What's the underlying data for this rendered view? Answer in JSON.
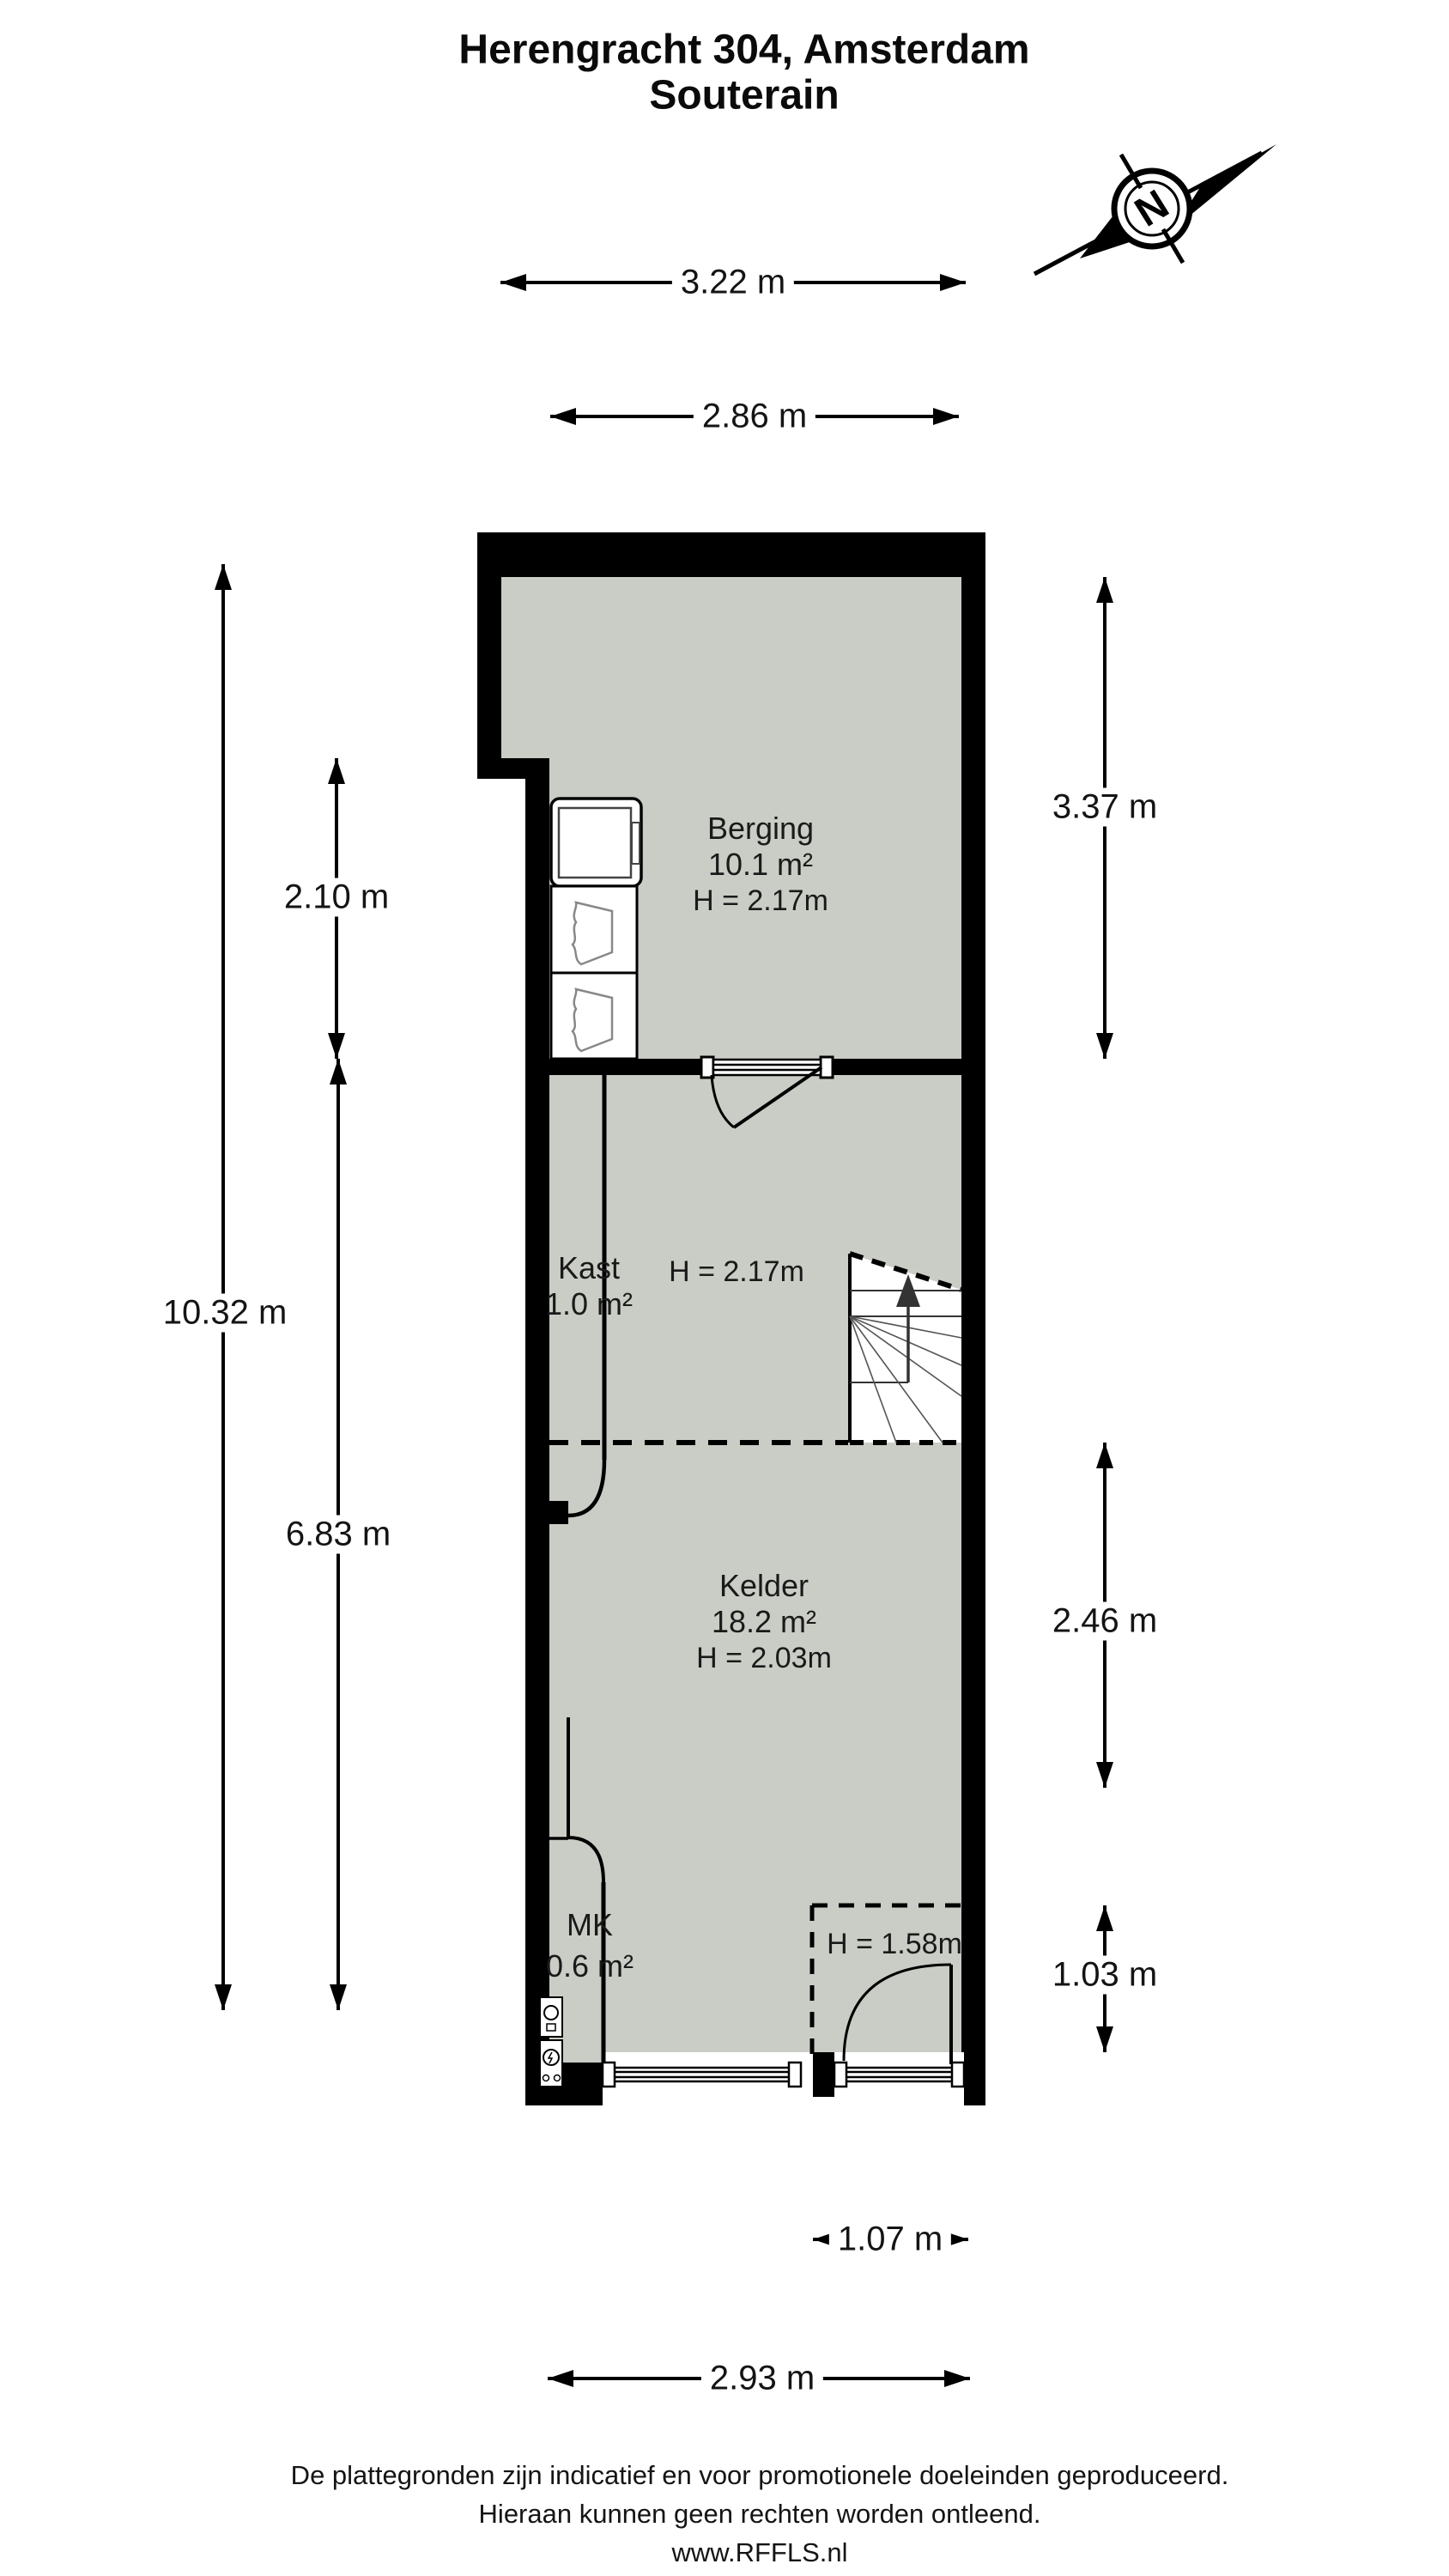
{
  "title": {
    "line1": "Herengracht 304, Amsterdam",
    "line2": "Souterain"
  },
  "compass": {
    "label": "N"
  },
  "dimensions": {
    "top": [
      {
        "label": "3.22 m",
        "meters": 3.22
      },
      {
        "label": "2.86 m",
        "meters": 2.86
      }
    ],
    "left": [
      {
        "label": "2.10 m",
        "meters": 2.1
      },
      {
        "label": "10.32 m",
        "meters": 10.32
      },
      {
        "label": "6.83 m",
        "meters": 6.83
      }
    ],
    "right": [
      {
        "label": "3.37 m",
        "meters": 3.37
      },
      {
        "label": "2.46 m",
        "meters": 2.46
      },
      {
        "label": "1.03 m",
        "meters": 1.03
      }
    ],
    "bottom": [
      {
        "label": "1.07 m",
        "meters": 1.07
      },
      {
        "label": "2.93 m",
        "meters": 2.93
      }
    ]
  },
  "rooms": [
    {
      "name": "Berging",
      "area": "10.1 m²",
      "height": "H = 2.17m"
    },
    {
      "name": "Kast",
      "area": "1.0 m²",
      "height": "H = 2.17m"
    },
    {
      "name": "Kelder",
      "area": "18.2 m²",
      "height": "H = 2.03m"
    },
    {
      "name": "MK",
      "area": "0.6 m²"
    }
  ],
  "annotations": {
    "low_ceiling": "H = 1.58m"
  },
  "footer": {
    "line1": "De plattegronden zijn indicatief en voor promotionele doeleinden geproduceerd.",
    "line2": "Hieraan kunnen geen rechten worden ontleend.",
    "line3": "www.RFFLS.nl"
  },
  "colors": {
    "wall": "#000000",
    "floor": "#cacdc5",
    "background": "#ffffff"
  }
}
